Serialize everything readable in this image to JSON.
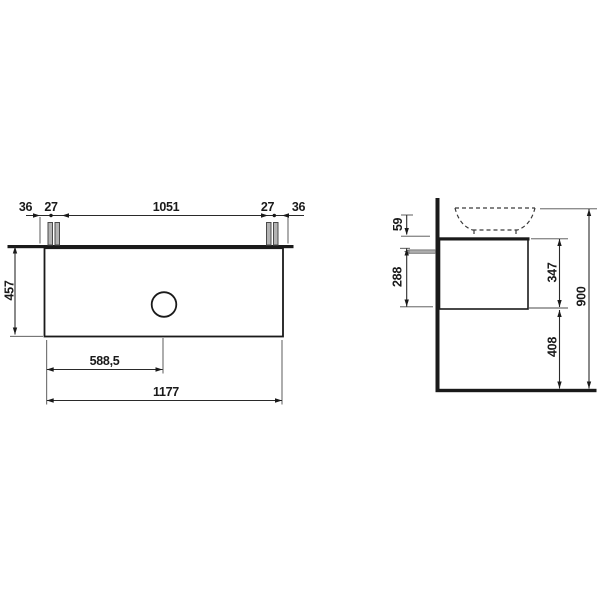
{
  "front_view": {
    "dim_36_left": "36",
    "dim_27_left": "27",
    "dim_1051": "1051",
    "dim_27_right": "27",
    "dim_36_right": "36",
    "dim_457": "457",
    "dim_588_5": "588,5",
    "dim_1177": "1177"
  },
  "side_view": {
    "dim_59": "59",
    "dim_288": "288",
    "dim_347": "347",
    "dim_408": "408",
    "dim_900": "900"
  },
  "colors": {
    "line": "#1a1a1a",
    "bolt_fill": "#b3b3b3",
    "background": "#ffffff"
  }
}
